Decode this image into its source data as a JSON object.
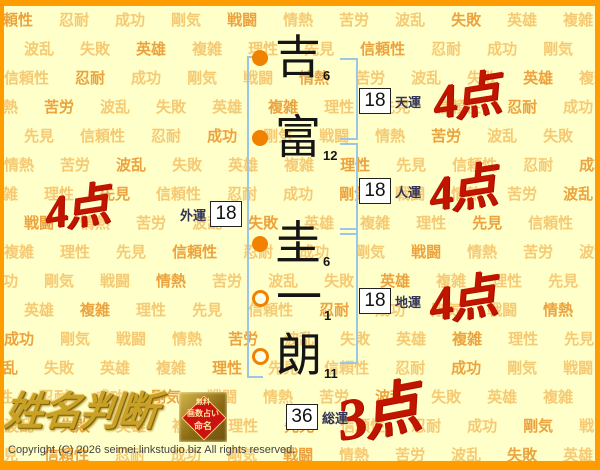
{
  "page": {
    "background_color": "#FFFFC9",
    "frame_color": "#FF9D00"
  },
  "background_pattern": {
    "words": [
      "信頼性",
      "忍耐",
      "成功",
      "剛気",
      "戦闘",
      "情熱",
      "苦労",
      "波乱",
      "失敗",
      "英雄",
      "複雑",
      "理性",
      "先見"
    ],
    "color_light": "#F6CA74",
    "color_dark": "#ECA33F"
  },
  "name": {
    "characters": [
      {
        "char": "吉",
        "strokes": 6,
        "marker": "filled"
      },
      {
        "char": "富",
        "strokes": 12,
        "marker": "filled"
      },
      {
        "char": "圭",
        "strokes": 6,
        "marker": "filled"
      },
      {
        "char": "一",
        "strokes": 1,
        "marker": "open"
      },
      {
        "char": "朗",
        "strokes": 11,
        "marker": "open"
      }
    ]
  },
  "fortunes": {
    "tenun": {
      "label": "天運",
      "value": 18,
      "score": "4点"
    },
    "jinun": {
      "label": "人運",
      "value": 18,
      "score": "4点"
    },
    "chiun": {
      "label": "地運",
      "value": 18,
      "score": "4点"
    },
    "gaiun": {
      "label": "外運",
      "value": 18,
      "score": "4点"
    },
    "souun": {
      "label": "総運",
      "value": 36,
      "score": "3点"
    }
  },
  "logo": {
    "title": "姓名判断"
  },
  "badge": {
    "line1": "無料",
    "line2": "画数占い",
    "line3": "命名"
  },
  "footer": {
    "copyright": "Copyright (C) 2026 seimei.linkstudio.biz All rights reserved."
  },
  "colors": {
    "score_red": "#C21500",
    "bracket_blue": "#9CC6E8",
    "marker_orange": "#F08200",
    "logo_gold": "#C9A125",
    "badge_red": "#CC1111"
  }
}
